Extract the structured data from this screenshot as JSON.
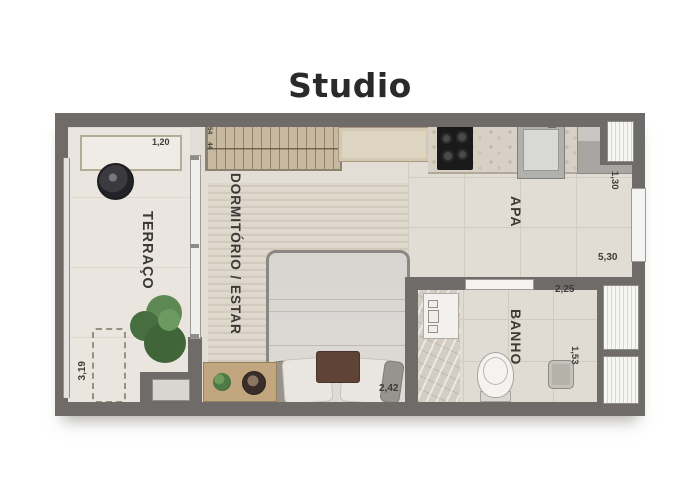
{
  "title": "Studio",
  "plan": {
    "rooms": {
      "terraco": {
        "label": "TERRAÇO"
      },
      "dormitorio": {
        "label": "DORMITÓRIO / ESTAR"
      },
      "apa": {
        "label": "APA"
      },
      "banho": {
        "label": "BANHO"
      }
    },
    "dimensions": {
      "planter_width": "1,20",
      "terraco_length": "3,19",
      "wardrobe_depth_a": "54",
      "wardrobe_depth_b": "44",
      "bed_width": "2,42",
      "apa_width": "1,30",
      "apa_length": "5,30",
      "banho_width": "2,25",
      "shower_length": "1,53"
    },
    "colors": {
      "wall": "#6e6b69",
      "terrace_floor": "#eae6df",
      "room_floor": "#e3ded5",
      "rug": "#d6cfc1",
      "counter_stone": "#d7d0c5",
      "wood": "#c2a67f",
      "plant_green": "#4e7a47",
      "cooktop_black": "#1a1a1a",
      "fixture_white": "#f3f2ef"
    }
  }
}
